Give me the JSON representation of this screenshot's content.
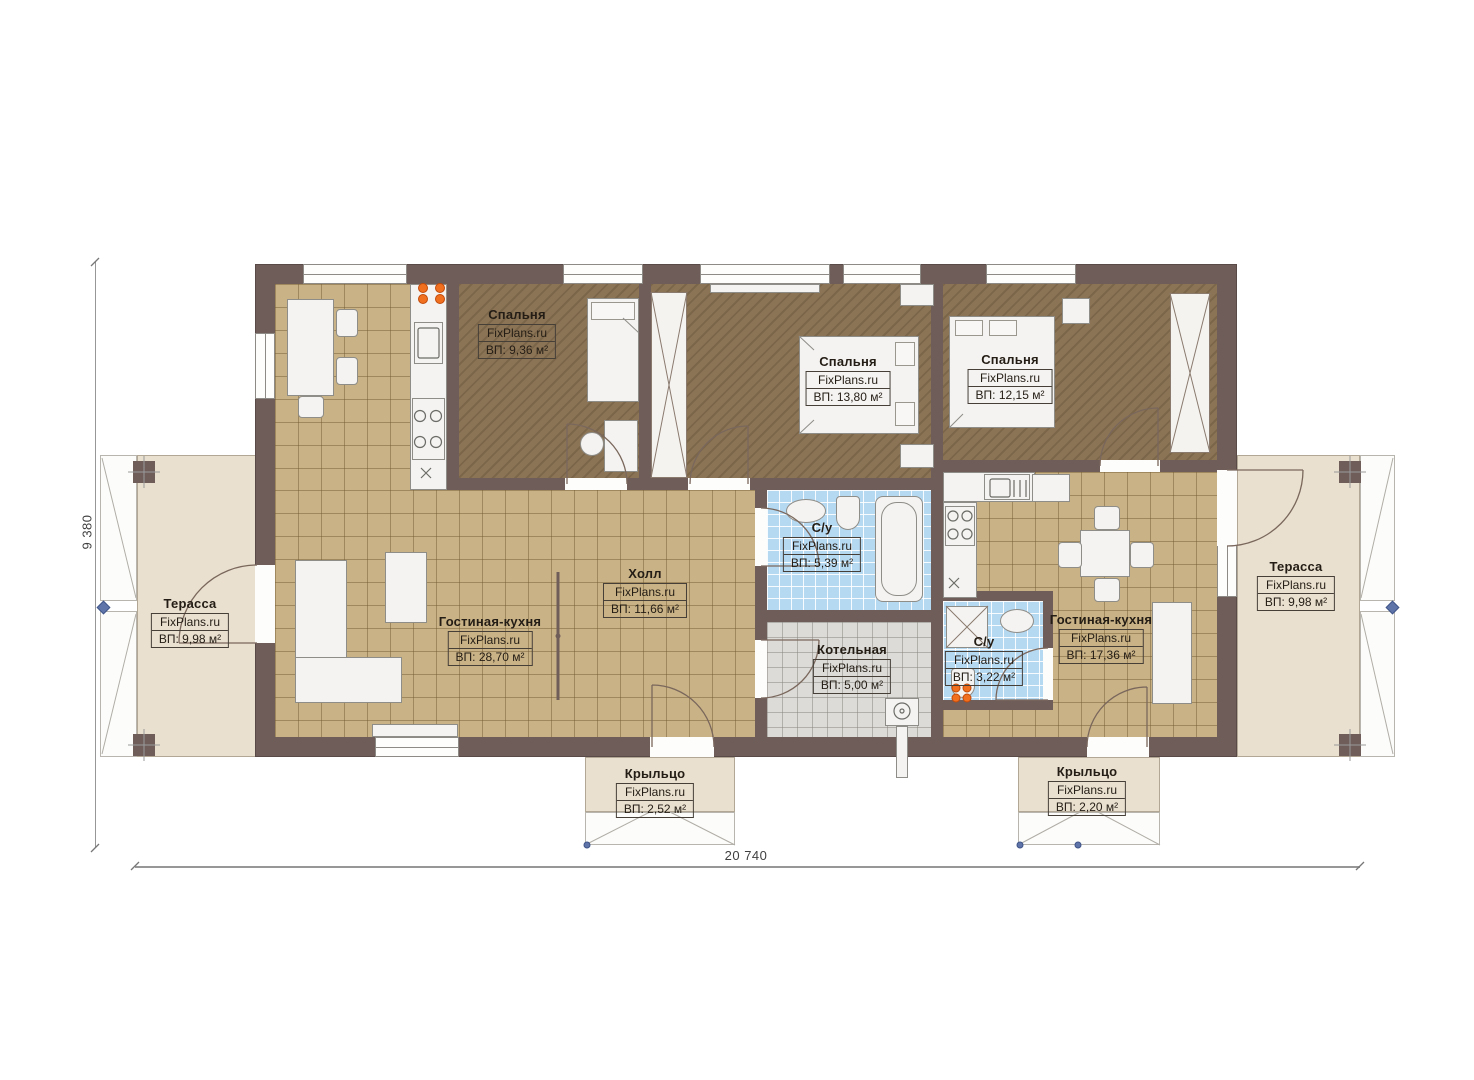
{
  "watermark": "FixPlans.ru",
  "plan": {
    "dim_width": "20 740",
    "dim_height": "9 380"
  },
  "rooms": {
    "bedroom1": {
      "name": "Спальня",
      "area": "ВП: 9,36 м²"
    },
    "bedroom2": {
      "name": "Спальня",
      "area": "ВП: 13,80 м²"
    },
    "bedroom3": {
      "name": "Спальня",
      "area": "ВП: 12,15 м²"
    },
    "hall": {
      "name": "Холл",
      "area": "ВП: 11,66 м²"
    },
    "living_left": {
      "name": "Гостиная-кухня",
      "area": "ВП: 28,70 м²"
    },
    "living_right": {
      "name": "Гостиная-кухня",
      "area": "ВП: 17,36 м²"
    },
    "bath_main": {
      "name": "С/у",
      "area": "ВП: 5,39 м²"
    },
    "bath_small": {
      "name": "С/у",
      "area": "ВП: 3,22 м²"
    },
    "boiler": {
      "name": "Котельная",
      "area": "ВП: 5,00 м²"
    },
    "terrace_left": {
      "name": "Терасса",
      "area": "ВП: 9,98 м²"
    },
    "terrace_right": {
      "name": "Терасса",
      "area": "ВП: 9,98 м²"
    },
    "porch_left": {
      "name": "Крыльцо",
      "area": "ВП: 2,52 м²"
    },
    "porch_right": {
      "name": "Крыльцо",
      "area": "ВП: 2,20 м²"
    }
  },
  "colors": {
    "wall": "#6f5d5a",
    "bedroom_floor": "#8b7456",
    "tile_floor": "#c9b286",
    "bath_floor": "#b6d9f2",
    "boiler_floor": "#dcdbd7",
    "terrace": "#e9e0cf",
    "marker_orange": "#f07020",
    "marker_blue": "#5f74a8"
  }
}
